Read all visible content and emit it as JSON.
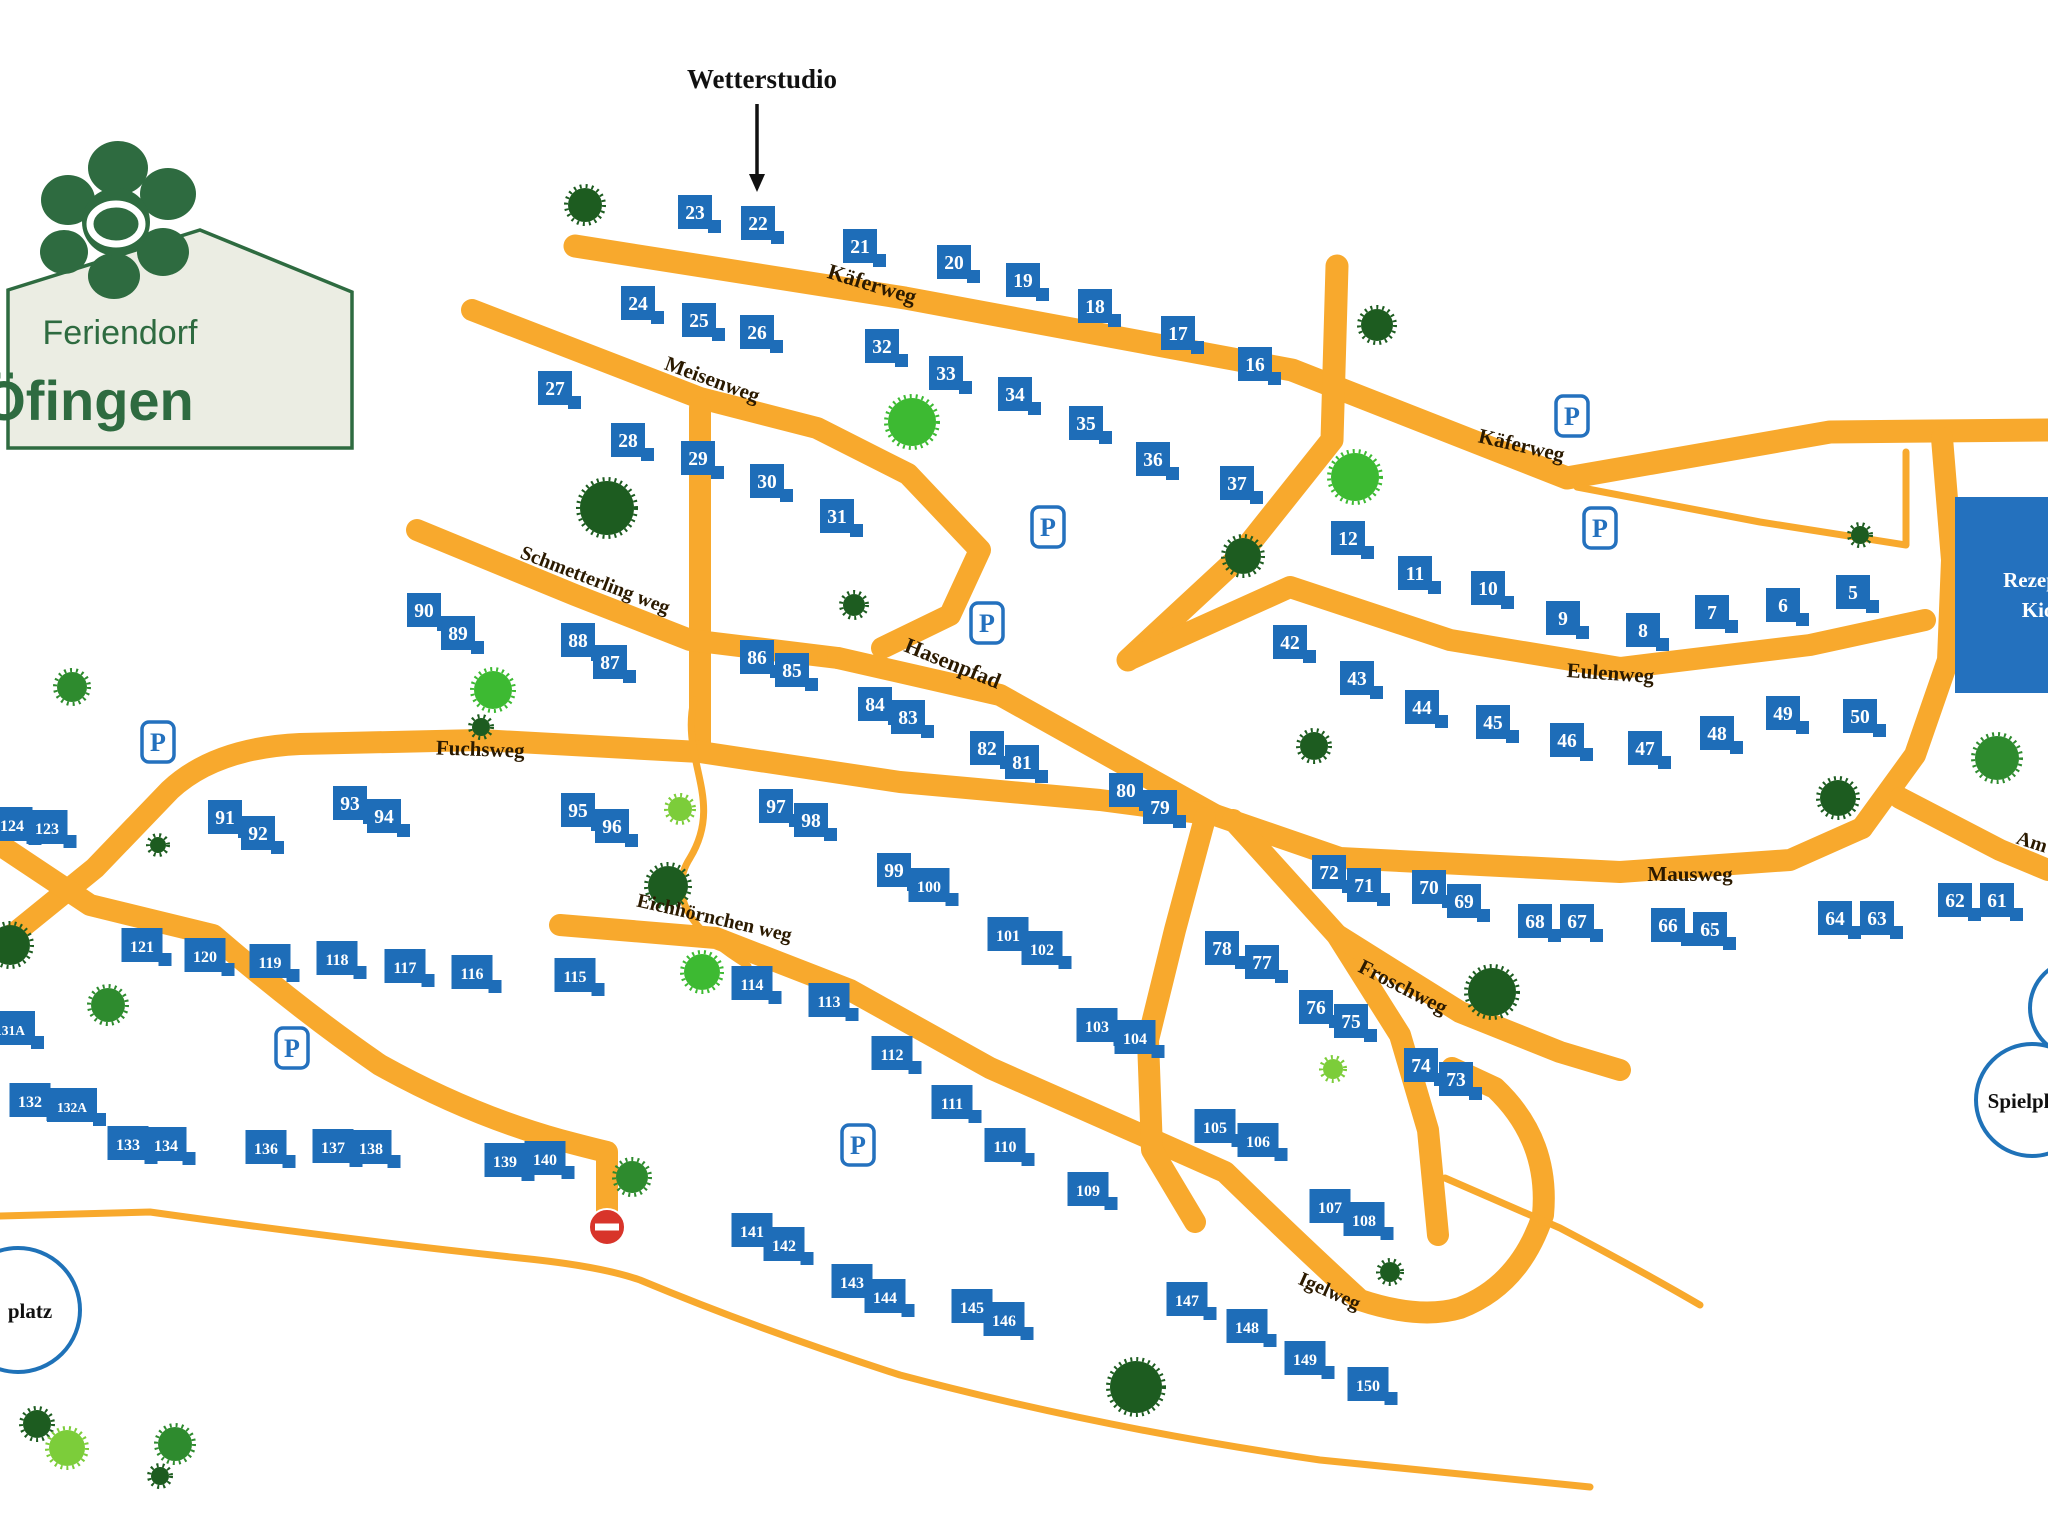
{
  "logo": {
    "line1": "Feriendorf",
    "line2": "Öfingen"
  },
  "annotation": {
    "label": "Wetterstudio",
    "x": 762,
    "y": 88,
    "arrow_x": 757,
    "arrow_y1": 104,
    "arrow_y2": 178
  },
  "colors": {
    "road": "#F8A92D",
    "house": "#1E6DB8",
    "house_text": "#FFFFFF",
    "parking": "#2471BE",
    "label": "#2B1A00",
    "no_entry": "#D8342A",
    "circle_border": "#1F72B8",
    "logo_green": "#2E6B40",
    "logo_bg": "#EBEDE3",
    "trees": {
      "dark": "#1D5C20",
      "mid": "#2E8B2E",
      "bright": "#3DBA32",
      "light": "#7CCD3A"
    }
  },
  "streets": [
    [
      "Käferweg",
      870,
      291,
      17,
      22
    ],
    [
      "Käferweg",
      1520,
      452,
      13,
      21
    ],
    [
      "Meisenweg",
      710,
      386,
      20,
      21
    ],
    [
      "Schmetterling weg",
      593,
      586,
      21,
      20
    ],
    [
      "Hasenpfad",
      950,
      670,
      22,
      22
    ],
    [
      "Fuchsweg",
      480,
      756,
      2,
      21
    ],
    [
      "Eulenweg",
      1610,
      680,
      4,
      21
    ],
    [
      "Mausweg",
      1690,
      881,
      0,
      21
    ],
    [
      "Eichhörnchen weg",
      713,
      924,
      13,
      20
    ],
    [
      "Froschweg",
      1400,
      993,
      27,
      21
    ],
    [
      "Igelweg",
      1327,
      1297,
      24,
      20
    ],
    [
      "Am",
      2030,
      848,
      18,
      20
    ]
  ],
  "houses": [
    [
      "23",
      695,
      212
    ],
    [
      "22",
      758,
      223
    ],
    [
      "21",
      860,
      246
    ],
    [
      "20",
      954,
      262
    ],
    [
      "19",
      1023,
      280
    ],
    [
      "18",
      1095,
      306
    ],
    [
      "17",
      1178,
      333
    ],
    [
      "16",
      1255,
      364
    ],
    [
      "24",
      638,
      303
    ],
    [
      "25",
      699,
      320
    ],
    [
      "26",
      757,
      332
    ],
    [
      "27",
      555,
      388
    ],
    [
      "28",
      628,
      440
    ],
    [
      "29",
      698,
      458
    ],
    [
      "30",
      767,
      481
    ],
    [
      "31",
      837,
      516
    ],
    [
      "32",
      882,
      346
    ],
    [
      "33",
      946,
      373
    ],
    [
      "34",
      1015,
      394
    ],
    [
      "35",
      1086,
      423
    ],
    [
      "36",
      1153,
      459
    ],
    [
      "37",
      1237,
      483
    ],
    [
      "12",
      1348,
      538
    ],
    [
      "11",
      1415,
      573
    ],
    [
      "10",
      1488,
      588
    ],
    [
      "9",
      1563,
      618
    ],
    [
      "8",
      1643,
      630
    ],
    [
      "7",
      1712,
      612
    ],
    [
      "6",
      1783,
      605
    ],
    [
      "5",
      1853,
      592
    ],
    [
      "42",
      1290,
      642
    ],
    [
      "43",
      1357,
      678
    ],
    [
      "44",
      1422,
      707
    ],
    [
      "45",
      1493,
      722
    ],
    [
      "46",
      1567,
      740
    ],
    [
      "47",
      1645,
      748
    ],
    [
      "48",
      1717,
      733
    ],
    [
      "49",
      1783,
      713
    ],
    [
      "50",
      1860,
      716
    ],
    [
      "90",
      424,
      610
    ],
    [
      "89",
      458,
      633
    ],
    [
      "88",
      578,
      640
    ],
    [
      "87",
      610,
      662
    ],
    [
      "86",
      757,
      657
    ],
    [
      "85",
      792,
      670
    ],
    [
      "84",
      875,
      704
    ],
    [
      "83",
      908,
      717
    ],
    [
      "82",
      987,
      748
    ],
    [
      "81",
      1022,
      762
    ],
    [
      "80",
      1126,
      790
    ],
    [
      "79",
      1160,
      807
    ],
    [
      "91",
      225,
      817
    ],
    [
      "92",
      258,
      833
    ],
    [
      "93",
      350,
      803
    ],
    [
      "94",
      384,
      816
    ],
    [
      "95",
      578,
      810
    ],
    [
      "96",
      612,
      826
    ],
    [
      "97",
      776,
      806
    ],
    [
      "98",
      811,
      820
    ],
    [
      "99",
      894,
      870
    ],
    [
      "100",
      929,
      885
    ],
    [
      "101",
      1008,
      934
    ],
    [
      "102",
      1042,
      948
    ],
    [
      "124",
      12,
      824
    ],
    [
      "123",
      47,
      827
    ],
    [
      "121",
      142,
      945
    ],
    [
      "120",
      205,
      955
    ],
    [
      "119",
      270,
      961
    ],
    [
      "118",
      337,
      958
    ],
    [
      "117",
      405,
      966
    ],
    [
      "116",
      472,
      972
    ],
    [
      "115",
      575,
      975
    ],
    [
      "114",
      752,
      983
    ],
    [
      "113",
      829,
      1000
    ],
    [
      "112",
      892,
      1053
    ],
    [
      "111",
      952,
      1102
    ],
    [
      "110",
      1005,
      1145
    ],
    [
      "109",
      1088,
      1189
    ],
    [
      "103",
      1097,
      1025
    ],
    [
      "104",
      1135,
      1037
    ],
    [
      "105",
      1215,
      1126
    ],
    [
      "106",
      1258,
      1140
    ],
    [
      "107",
      1330,
      1206
    ],
    [
      "108",
      1364,
      1219
    ],
    [
      "72",
      1329,
      872
    ],
    [
      "71",
      1364,
      885
    ],
    [
      "70",
      1429,
      887
    ],
    [
      "69",
      1464,
      901
    ],
    [
      "68",
      1535,
      921
    ],
    [
      "67",
      1577,
      921
    ],
    [
      "66",
      1668,
      925
    ],
    [
      "65",
      1710,
      929
    ],
    [
      "64",
      1835,
      918
    ],
    [
      "63",
      1877,
      918
    ],
    [
      "62",
      1955,
      900
    ],
    [
      "61",
      1997,
      900
    ],
    [
      "78",
      1222,
      948
    ],
    [
      "77",
      1262,
      962
    ],
    [
      "76",
      1316,
      1007
    ],
    [
      "75",
      1351,
      1021
    ],
    [
      "74",
      1421,
      1065
    ],
    [
      "73",
      1456,
      1079
    ],
    [
      "131A",
      10,
      1028
    ],
    [
      "132",
      30,
      1100
    ],
    [
      "132A",
      72,
      1105
    ],
    [
      "133",
      128,
      1143
    ],
    [
      "134",
      166,
      1144
    ],
    [
      "136",
      266,
      1147
    ],
    [
      "137",
      333,
      1146
    ],
    [
      "138",
      371,
      1147
    ],
    [
      "139",
      505,
      1160
    ],
    [
      "140",
      545,
      1158
    ],
    [
      "141",
      752,
      1230
    ],
    [
      "142",
      784,
      1244
    ],
    [
      "143",
      852,
      1281
    ],
    [
      "144",
      885,
      1296
    ],
    [
      "145",
      972,
      1306
    ],
    [
      "146",
      1004,
      1319
    ],
    [
      "147",
      1187,
      1299
    ],
    [
      "148",
      1247,
      1326
    ],
    [
      "149",
      1305,
      1358
    ],
    [
      "150",
      1368,
      1384
    ]
  ],
  "parking": [
    [
      158,
      742
    ],
    [
      1048,
      527
    ],
    [
      987,
      623
    ],
    [
      1572,
      416
    ],
    [
      1600,
      528
    ],
    [
      858,
      1145
    ],
    [
      292,
      1048
    ]
  ],
  "trees": [
    [
      585,
      205,
      17,
      "dark"
    ],
    [
      912,
      422,
      24,
      "bright"
    ],
    [
      607,
      508,
      27,
      "dark"
    ],
    [
      1355,
      477,
      24,
      "bright"
    ],
    [
      1243,
      556,
      18,
      "dark"
    ],
    [
      1377,
      325,
      16,
      "dark"
    ],
    [
      854,
      605,
      11,
      "dark"
    ],
    [
      680,
      809,
      12,
      "light"
    ],
    [
      668,
      886,
      20,
      "dark"
    ],
    [
      72,
      687,
      15,
      "mid"
    ],
    [
      10,
      945,
      20,
      "dark"
    ],
    [
      108,
      1005,
      17,
      "mid"
    ],
    [
      158,
      845,
      8,
      "dark"
    ],
    [
      702,
      972,
      18,
      "bright"
    ],
    [
      1492,
      992,
      24,
      "dark"
    ],
    [
      1333,
      1069,
      10,
      "light"
    ],
    [
      632,
      1177,
      16,
      "mid"
    ],
    [
      1136,
      1387,
      26,
      "dark"
    ],
    [
      1390,
      1272,
      10,
      "dark"
    ],
    [
      1997,
      758,
      22,
      "mid"
    ],
    [
      1838,
      798,
      18,
      "dark"
    ],
    [
      1860,
      535,
      9,
      "dark"
    ],
    [
      493,
      690,
      19,
      "bright"
    ],
    [
      481,
      727,
      9,
      "dark"
    ],
    [
      1314,
      746,
      14,
      "dark"
    ],
    [
      37,
      1424,
      14,
      "dark"
    ],
    [
      67,
      1448,
      18,
      "light"
    ],
    [
      175,
      1444,
      17,
      "mid"
    ],
    [
      160,
      1476,
      9,
      "dark"
    ]
  ],
  "roads": [
    {
      "name": "kaeferweg",
      "w": 23,
      "d": "M575,246 L905,298 L1292,370 L1567,478 L1830,432 L2048,430"
    },
    {
      "name": "top-vertical",
      "w": 23,
      "d": "M1337,266 L1332,440 L1238,558 L1128,660"
    },
    {
      "name": "meisenweg",
      "w": 22,
      "d": "M472,310 L700,398 L817,428 L908,474 L980,550 L950,615 L882,648"
    },
    {
      "name": "connector",
      "w": 22,
      "d": "M700,408 L700,748"
    },
    {
      "name": "schmetterlingweg",
      "w": 22,
      "d": "M417,530 L575,595 L690,640 L838,658"
    },
    {
      "name": "hasenpfad",
      "w": 22,
      "d": "M838,658 L1000,695 L1120,762 L1215,815"
    },
    {
      "name": "fuchsweg",
      "w": 22,
      "d": "M0,945 L95,868 L170,790 Q215,748 300,744 L480,740 L700,752 L900,782 L1100,800 L1215,815"
    },
    {
      "name": "left-loop",
      "w": 22,
      "d": "M0,845 L90,905 L213,935 Q300,1010 380,1065 Q470,1115 560,1140 Q590,1148 607,1152 L607,1210"
    },
    {
      "name": "eichhoernchen-igelweg",
      "w": 22,
      "d": "M560,925 L716,938 L850,990 L990,1068 L1135,1132 L1225,1172 Q1300,1245 1360,1300 Q1420,1320 1460,1308 Q1520,1285 1543,1215 Q1550,1140 1495,1088 L1452,1068"
    },
    {
      "name": "eulenweg",
      "w": 22,
      "d": "M1128,660 L1290,587 L1450,640 L1620,668 L1810,645 L1925,620"
    },
    {
      "name": "mausweg",
      "w": 22,
      "d": "M1215,815 L1340,858 L1620,872 L1790,860 L1862,828"
    },
    {
      "name": "right-loop",
      "w": 22,
      "d": "M1942,438 L1952,560 L1948,660 L1915,755 L1862,828"
    },
    {
      "name": "am-branch",
      "w": 22,
      "d": "M1900,798 L2000,850 L2048,870"
    },
    {
      "name": "froschweg-south",
      "w": 22,
      "d": "M1233,820 L1337,935 L1400,1035 L1428,1130 L1438,1235"
    },
    {
      "name": "froschweg",
      "w": 22,
      "d": "M1337,935 L1460,1012 L1560,1052 L1620,1070"
    },
    {
      "name": "south-connector",
      "w": 22,
      "d": "M1205,818 L1175,930 L1148,1040 L1152,1150 L1195,1222"
    },
    {
      "name": "thin-kaeferweg-loop",
      "w": 7,
      "d": "M1577,487 L1760,522 L1906,545 L1906,452"
    },
    {
      "name": "thin-south-path",
      "w": 7,
      "d": "M0,1216 L150,1212 Q350,1240 520,1258 Q600,1266 640,1280 Q760,1330 900,1375 Q1100,1428 1320,1460 L1590,1487"
    },
    {
      "name": "thin-east-path",
      "w": 7,
      "d": "M1445,1178 L1560,1228 Q1640,1270 1700,1305"
    },
    {
      "name": "thin-s-path",
      "w": 7,
      "d": "M694,700 C680,760 725,800 690,858 C662,902 705,940 748,966"
    }
  ],
  "no_entry": {
    "x": 607,
    "y": 1227,
    "r": 18
  },
  "landmarks": {
    "rezeption": {
      "x": 1955,
      "y": 497,
      "w": 115,
      "h": 196,
      "line1": "Rezeption",
      "line2": "Kiosk"
    },
    "spielplatz": {
      "cx": 2032,
      "cy": 1100,
      "r": 56,
      "label": "Spielplatz",
      "cx2": 2078,
      "cy2": 1008,
      "r2": 48
    },
    "platz": {
      "cx": 18,
      "cy": 1310,
      "r": 62,
      "label": "platz"
    }
  }
}
